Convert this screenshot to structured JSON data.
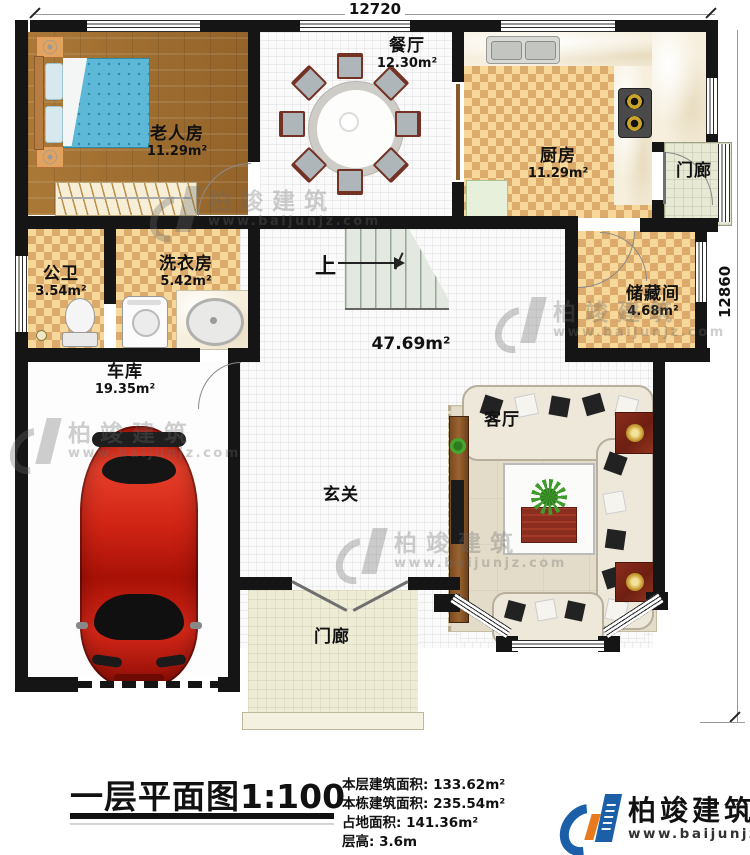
{
  "plan": {
    "dimensions": {
      "top": "12720",
      "right": "12860"
    },
    "stairs_label": "上",
    "rooms": [
      {
        "name": "老人房",
        "area": "11.29m²"
      },
      {
        "name": "餐厅",
        "area": "12.30m²"
      },
      {
        "name": "厨房",
        "area": "11.29m²"
      },
      {
        "name": "门廊",
        "area": ""
      },
      {
        "name": "储藏间",
        "area": "4.68m²"
      },
      {
        "name": "公卫",
        "area": "3.54m²"
      },
      {
        "name": "洗衣房",
        "area": "5.42m²"
      },
      {
        "name": "车库",
        "area": "19.35m²"
      },
      {
        "name": "客厅",
        "area": ""
      },
      {
        "name": "玄关",
        "area": ""
      },
      {
        "name": "门廊",
        "area": ""
      },
      {
        "name": "",
        "area": "47.69m²"
      }
    ]
  },
  "title_block": {
    "title": "一层平面图",
    "scale": "1:100",
    "stats": [
      {
        "label": "本层建筑面积:",
        "value": "133.62m²"
      },
      {
        "label": "本栋建筑面积:",
        "value": "235.54m²"
      },
      {
        "label": "占地面积:",
        "value": "141.36m²"
      },
      {
        "label": "层高:",
        "value": "3.6m"
      }
    ]
  },
  "brand": {
    "name": "柏竣建筑",
    "url": "www.baijunjz.com",
    "blue": "#1a5fa8",
    "orange": "#e87a1e"
  },
  "watermark": {
    "name": "柏竣建筑",
    "url": "www.baijunjz.com"
  }
}
